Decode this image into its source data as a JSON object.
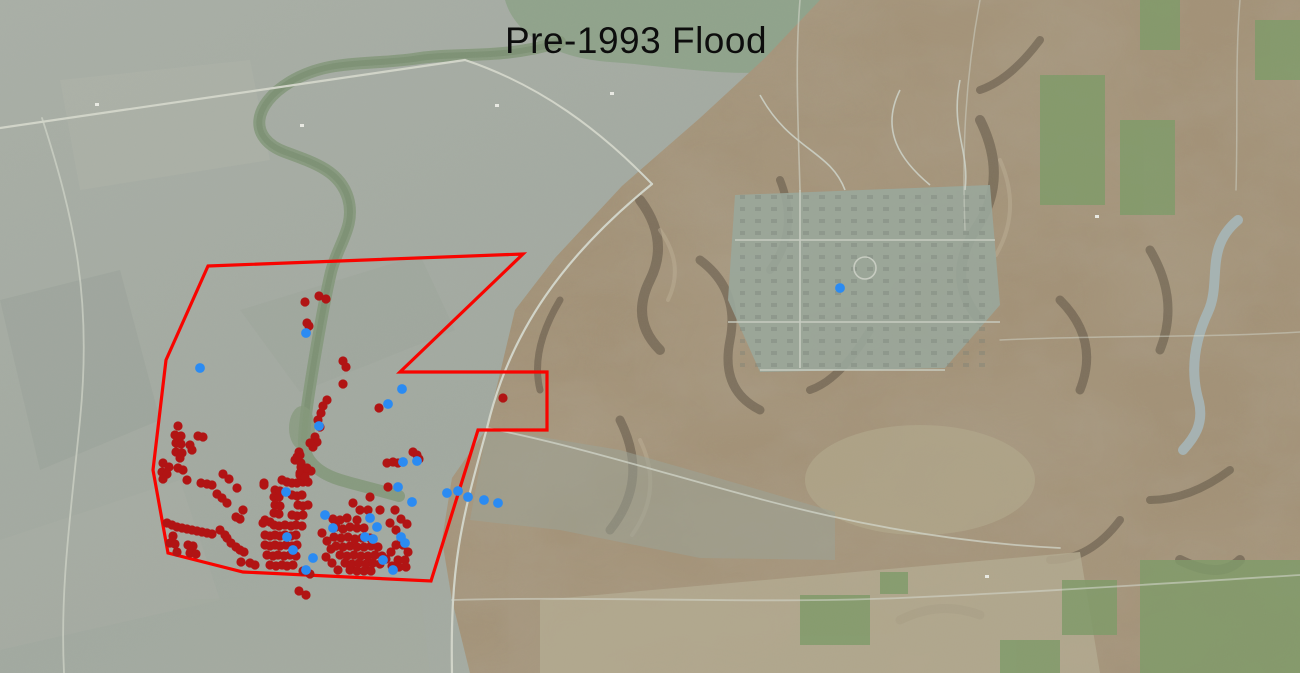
{
  "title": "Pre-1993 Flood",
  "map": {
    "outline_color": "#f80400",
    "red_point_color": "#b11414",
    "blue_point_color": "#2b8bf2",
    "study_area_outline": [
      [
        208,
        266
      ],
      [
        523,
        254
      ],
      [
        400,
        372
      ],
      [
        547,
        372
      ],
      [
        547,
        430
      ],
      [
        478,
        430
      ],
      [
        431,
        581
      ],
      [
        243,
        572
      ],
      [
        168,
        553
      ],
      [
        153,
        470
      ],
      [
        166,
        360
      ]
    ],
    "red_points": [
      [
        305,
        302
      ],
      [
        319,
        296
      ],
      [
        326,
        299
      ],
      [
        307,
        323
      ],
      [
        309,
        326
      ],
      [
        343,
        361
      ],
      [
        346,
        367
      ],
      [
        343,
        384
      ],
      [
        327,
        400
      ],
      [
        323,
        406
      ],
      [
        321,
        413
      ],
      [
        318,
        420
      ],
      [
        320,
        427
      ],
      [
        315,
        437
      ],
      [
        317,
        442
      ],
      [
        313,
        447
      ],
      [
        379,
        408
      ],
      [
        503,
        398
      ],
      [
        178,
        426
      ],
      [
        175,
        435
      ],
      [
        181,
        436
      ],
      [
        198,
        436
      ],
      [
        203,
        437
      ],
      [
        176,
        443
      ],
      [
        181,
        444
      ],
      [
        190,
        445
      ],
      [
        176,
        452
      ],
      [
        182,
        453
      ],
      [
        192,
        450
      ],
      [
        180,
        458
      ],
      [
        163,
        463
      ],
      [
        169,
        467
      ],
      [
        162,
        472
      ],
      [
        167,
        474
      ],
      [
        178,
        468
      ],
      [
        183,
        470
      ],
      [
        163,
        479
      ],
      [
        187,
        480
      ],
      [
        201,
        483
      ],
      [
        207,
        484
      ],
      [
        212,
        485
      ],
      [
        217,
        494
      ],
      [
        222,
        498
      ],
      [
        227,
        503
      ],
      [
        223,
        474
      ],
      [
        229,
        479
      ],
      [
        237,
        488
      ],
      [
        243,
        510
      ],
      [
        236,
        517
      ],
      [
        240,
        519
      ],
      [
        264,
        483
      ],
      [
        167,
        523
      ],
      [
        172,
        525
      ],
      [
        177,
        527
      ],
      [
        182,
        528
      ],
      [
        187,
        529
      ],
      [
        192,
        530
      ],
      [
        197,
        531
      ],
      [
        202,
        532
      ],
      [
        207,
        533
      ],
      [
        212,
        534
      ],
      [
        220,
        530
      ],
      [
        225,
        535
      ],
      [
        173,
        536
      ],
      [
        170,
        543
      ],
      [
        175,
        544
      ],
      [
        188,
        545
      ],
      [
        193,
        546
      ],
      [
        177,
        552
      ],
      [
        190,
        553
      ],
      [
        196,
        554
      ],
      [
        227,
        538
      ],
      [
        231,
        543
      ],
      [
        236,
        547
      ],
      [
        240,
        550
      ],
      [
        244,
        552
      ],
      [
        241,
        562
      ],
      [
        250,
        563
      ],
      [
        255,
        565
      ],
      [
        299,
        591
      ],
      [
        306,
        595
      ],
      [
        310,
        443
      ],
      [
        299,
        452
      ],
      [
        295,
        460
      ],
      [
        301,
        463
      ],
      [
        306,
        469
      ],
      [
        311,
        471
      ],
      [
        300,
        473
      ],
      [
        282,
        480
      ],
      [
        287,
        482
      ],
      [
        292,
        483
      ],
      [
        297,
        483
      ],
      [
        303,
        482
      ],
      [
        308,
        482
      ],
      [
        275,
        490
      ],
      [
        280,
        491
      ],
      [
        274,
        497
      ],
      [
        279,
        497
      ],
      [
        292,
        495
      ],
      [
        297,
        496
      ],
      [
        302,
        495
      ],
      [
        275,
        505
      ],
      [
        280,
        506
      ],
      [
        298,
        505
      ],
      [
        303,
        506
      ],
      [
        308,
        505
      ],
      [
        274,
        513
      ],
      [
        279,
        514
      ],
      [
        292,
        515
      ],
      [
        297,
        516
      ],
      [
        303,
        515
      ],
      [
        265,
        520
      ],
      [
        270,
        522
      ],
      [
        274,
        525
      ],
      [
        279,
        526
      ],
      [
        285,
        525
      ],
      [
        291,
        526
      ],
      [
        296,
        525
      ],
      [
        302,
        526
      ],
      [
        265,
        535
      ],
      [
        270,
        536
      ],
      [
        275,
        535
      ],
      [
        280,
        536
      ],
      [
        285,
        535
      ],
      [
        291,
        536
      ],
      [
        296,
        535
      ],
      [
        265,
        545
      ],
      [
        270,
        546
      ],
      [
        275,
        545
      ],
      [
        280,
        546
      ],
      [
        286,
        545
      ],
      [
        292,
        546
      ],
      [
        297,
        545
      ],
      [
        267,
        555
      ],
      [
        273,
        556
      ],
      [
        278,
        555
      ],
      [
        284,
        556
      ],
      [
        290,
        555
      ],
      [
        296,
        556
      ],
      [
        270,
        565
      ],
      [
        276,
        566
      ],
      [
        282,
        565
      ],
      [
        287,
        566
      ],
      [
        293,
        565
      ],
      [
        264,
        485
      ],
      [
        263,
        523
      ],
      [
        303,
        571
      ],
      [
        310,
        574
      ],
      [
        300,
        455
      ],
      [
        297,
        457
      ],
      [
        301,
        467
      ],
      [
        307,
        468
      ],
      [
        300,
        475
      ],
      [
        305,
        477
      ],
      [
        387,
        463
      ],
      [
        393,
        462
      ],
      [
        398,
        463
      ],
      [
        388,
        487
      ],
      [
        370,
        497
      ],
      [
        353,
        503
      ],
      [
        360,
        510
      ],
      [
        368,
        510
      ],
      [
        380,
        510
      ],
      [
        395,
        510
      ],
      [
        413,
        452
      ],
      [
        417,
        455
      ],
      [
        419,
        459
      ],
      [
        333,
        519
      ],
      [
        340,
        520
      ],
      [
        347,
        518
      ],
      [
        357,
        520
      ],
      [
        336,
        527
      ],
      [
        343,
        529
      ],
      [
        350,
        527
      ],
      [
        357,
        528
      ],
      [
        364,
        528
      ],
      [
        334,
        537
      ],
      [
        341,
        538
      ],
      [
        348,
        537
      ],
      [
        355,
        539
      ],
      [
        362,
        538
      ],
      [
        370,
        538
      ],
      [
        336,
        546
      ],
      [
        343,
        547
      ],
      [
        350,
        546
      ],
      [
        357,
        547
      ],
      [
        364,
        547
      ],
      [
        371,
        546
      ],
      [
        378,
        547
      ],
      [
        340,
        555
      ],
      [
        347,
        556
      ],
      [
        354,
        555
      ],
      [
        361,
        556
      ],
      [
        368,
        556
      ],
      [
        375,
        555
      ],
      [
        382,
        556
      ],
      [
        345,
        563
      ],
      [
        352,
        564
      ],
      [
        359,
        563
      ],
      [
        366,
        564
      ],
      [
        373,
        563
      ],
      [
        380,
        564
      ],
      [
        350,
        570
      ],
      [
        357,
        571
      ],
      [
        364,
        571
      ],
      [
        371,
        571
      ],
      [
        386,
        559
      ],
      [
        391,
        552
      ],
      [
        396,
        545
      ],
      [
        401,
        538
      ],
      [
        396,
        530
      ],
      [
        390,
        523
      ],
      [
        401,
        519
      ],
      [
        407,
        524
      ],
      [
        403,
        545
      ],
      [
        408,
        552
      ],
      [
        398,
        560
      ],
      [
        405,
        560
      ],
      [
        392,
        566
      ],
      [
        399,
        567
      ],
      [
        406,
        567
      ],
      [
        322,
        533
      ],
      [
        327,
        541
      ],
      [
        331,
        549
      ],
      [
        326,
        557
      ],
      [
        332,
        563
      ],
      [
        338,
        570
      ]
    ],
    "blue_points": [
      [
        200,
        368
      ],
      [
        306,
        333
      ],
      [
        319,
        426
      ],
      [
        388,
        404
      ],
      [
        402,
        389
      ],
      [
        403,
        462
      ],
      [
        398,
        487
      ],
      [
        417,
        461
      ],
      [
        412,
        502
      ],
      [
        447,
        493
      ],
      [
        458,
        491
      ],
      [
        468,
        497
      ],
      [
        484,
        500
      ],
      [
        498,
        503
      ],
      [
        840,
        288
      ],
      [
        286,
        492
      ],
      [
        325,
        515
      ],
      [
        333,
        528
      ],
      [
        293,
        550
      ],
      [
        313,
        558
      ],
      [
        287,
        537
      ],
      [
        306,
        570
      ],
      [
        370,
        518
      ],
      [
        377,
        527
      ],
      [
        365,
        537
      ],
      [
        373,
        539
      ],
      [
        383,
        560
      ],
      [
        401,
        537
      ],
      [
        405,
        543
      ],
      [
        393,
        570
      ]
    ]
  }
}
